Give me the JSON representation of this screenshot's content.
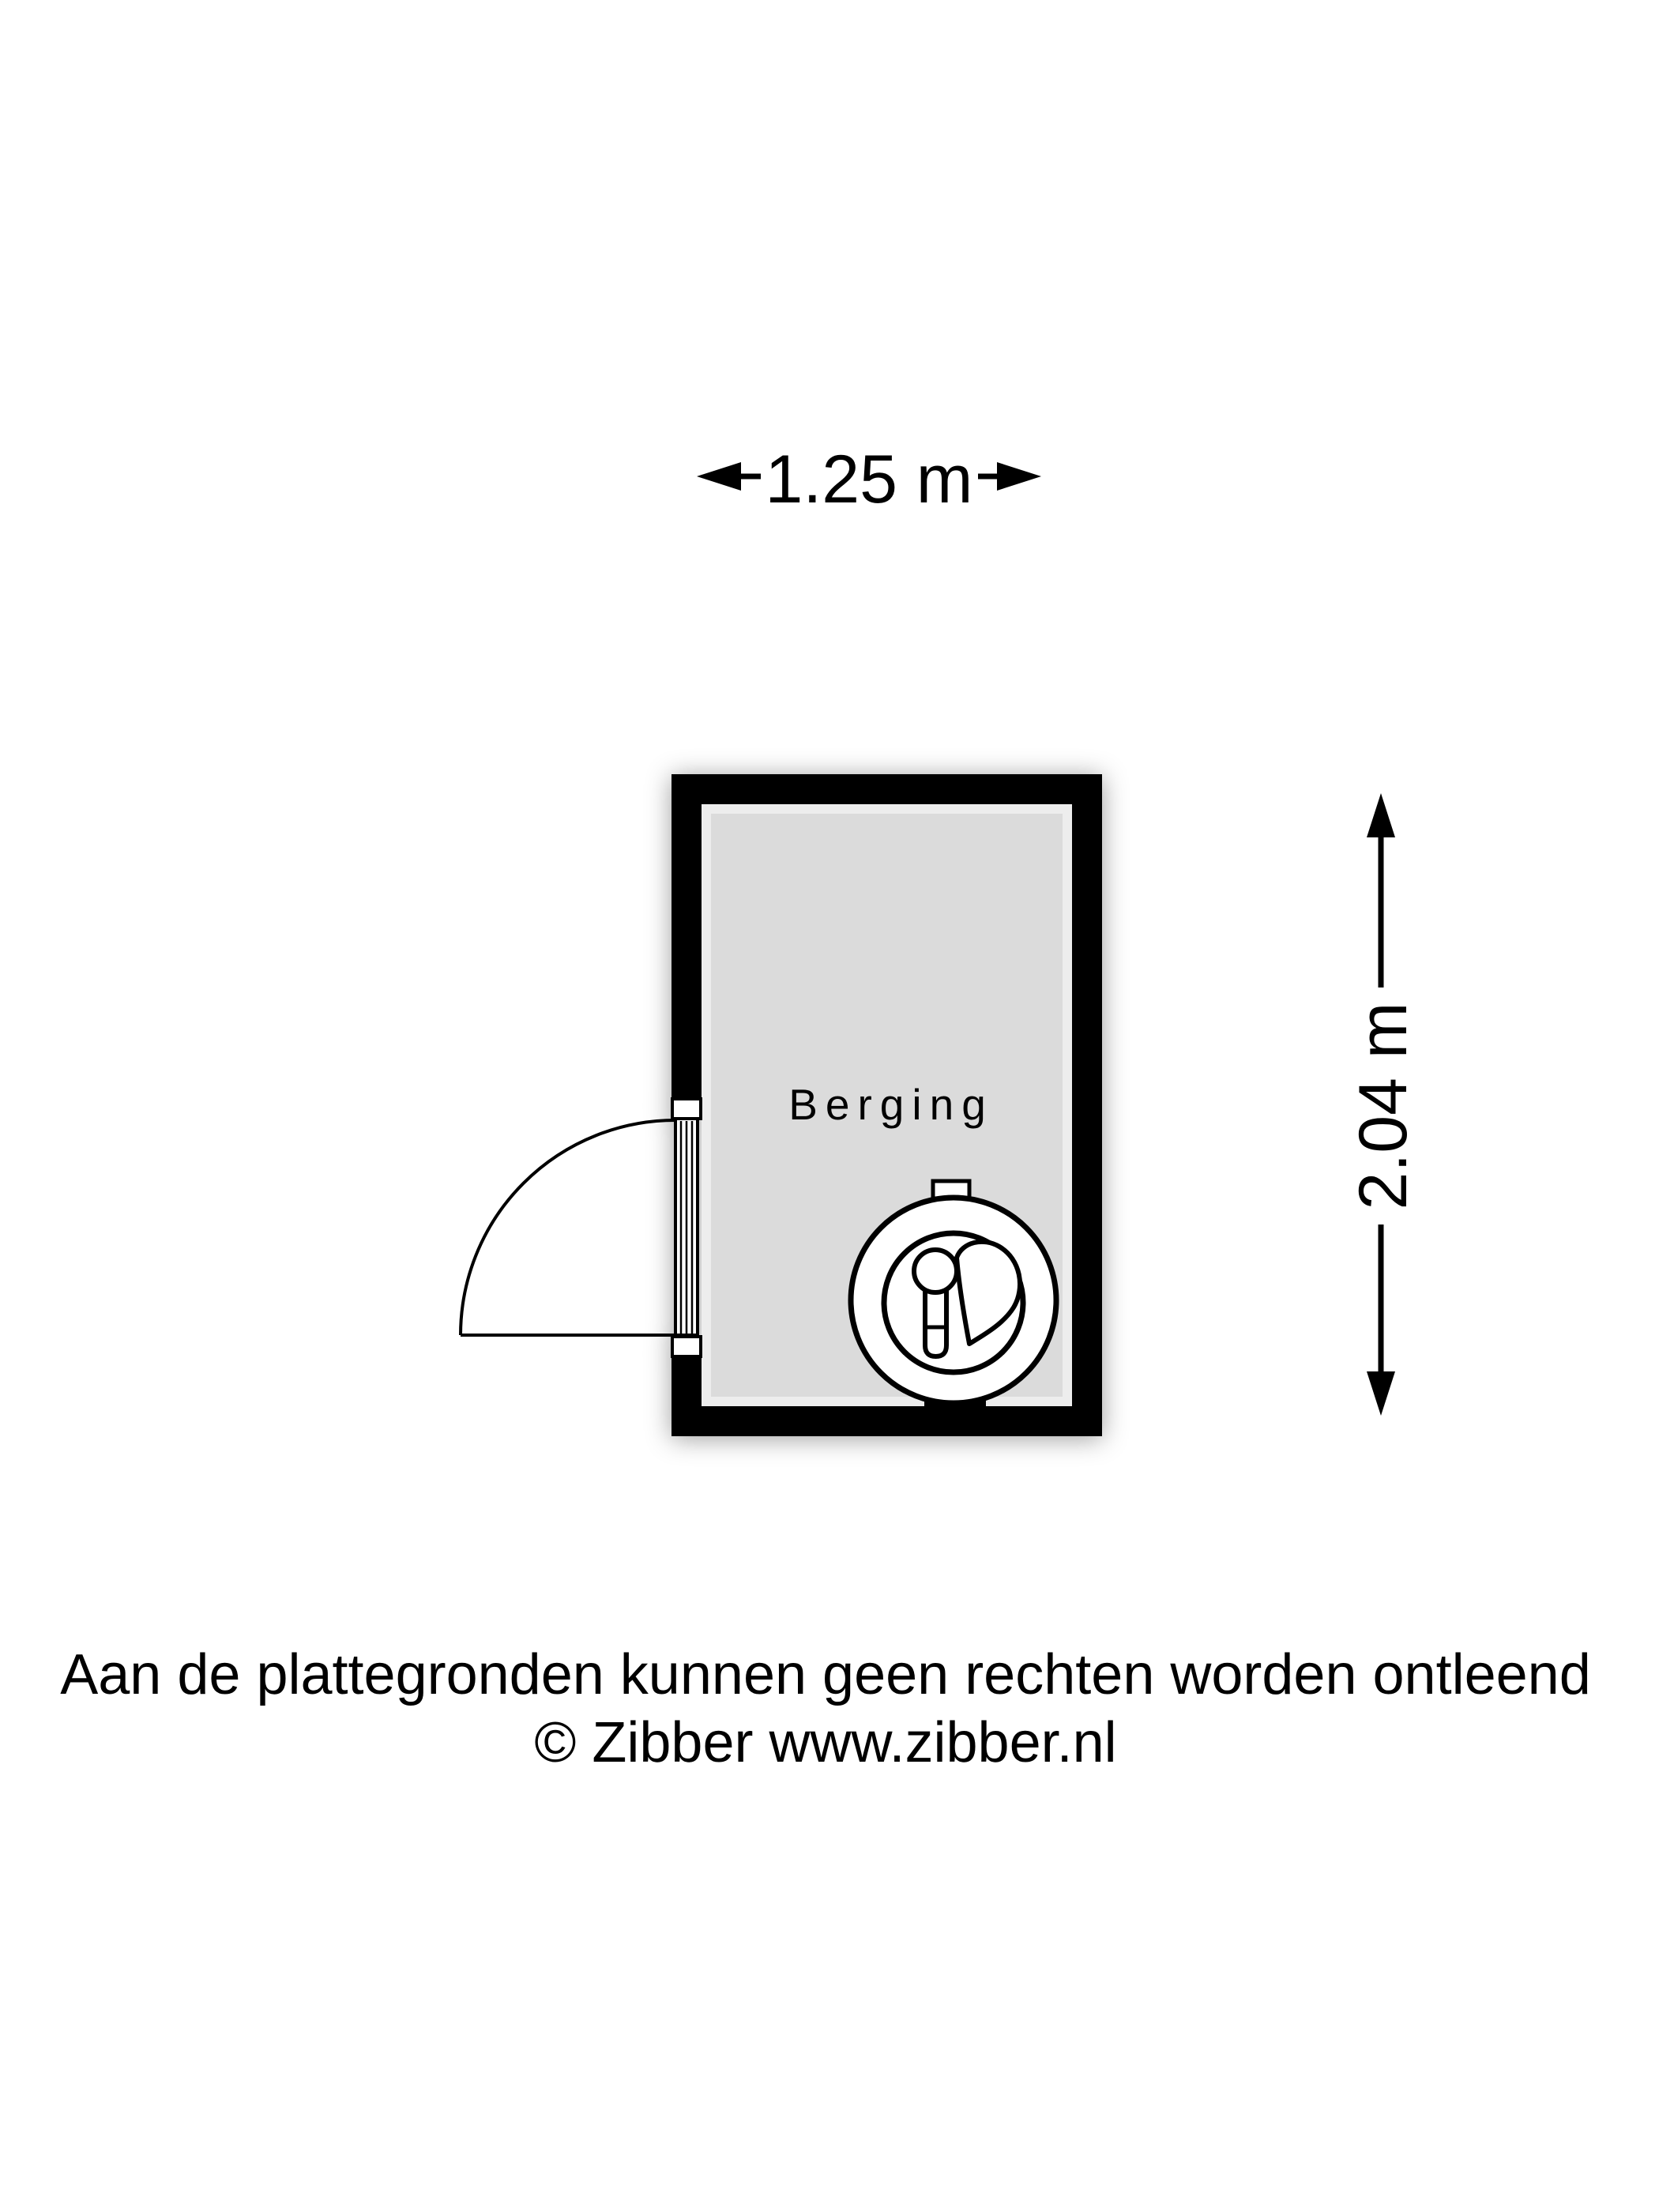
{
  "colors": {
    "background": "#ffffff",
    "wall": "#000000",
    "floor": "#dbdbdb",
    "line": "#000000",
    "text": "#000000"
  },
  "dimensions": {
    "width": {
      "label": "1.25 m"
    },
    "height": {
      "label": "2.04 m"
    }
  },
  "room": {
    "label": "Berging"
  },
  "icons": {
    "appliance": "boiler-icon",
    "door": "door-swing-icon",
    "width_arrows": [
      "arrow-left-icon",
      "arrow-right-icon"
    ],
    "height_arrows": [
      "arrow-up-icon",
      "arrow-down-icon"
    ]
  },
  "footer": {
    "disclaimer": "Aan de plattegronden kunnen geen rechten worden ontleend",
    "copyright": "© Zibber www.zibber.nl"
  }
}
